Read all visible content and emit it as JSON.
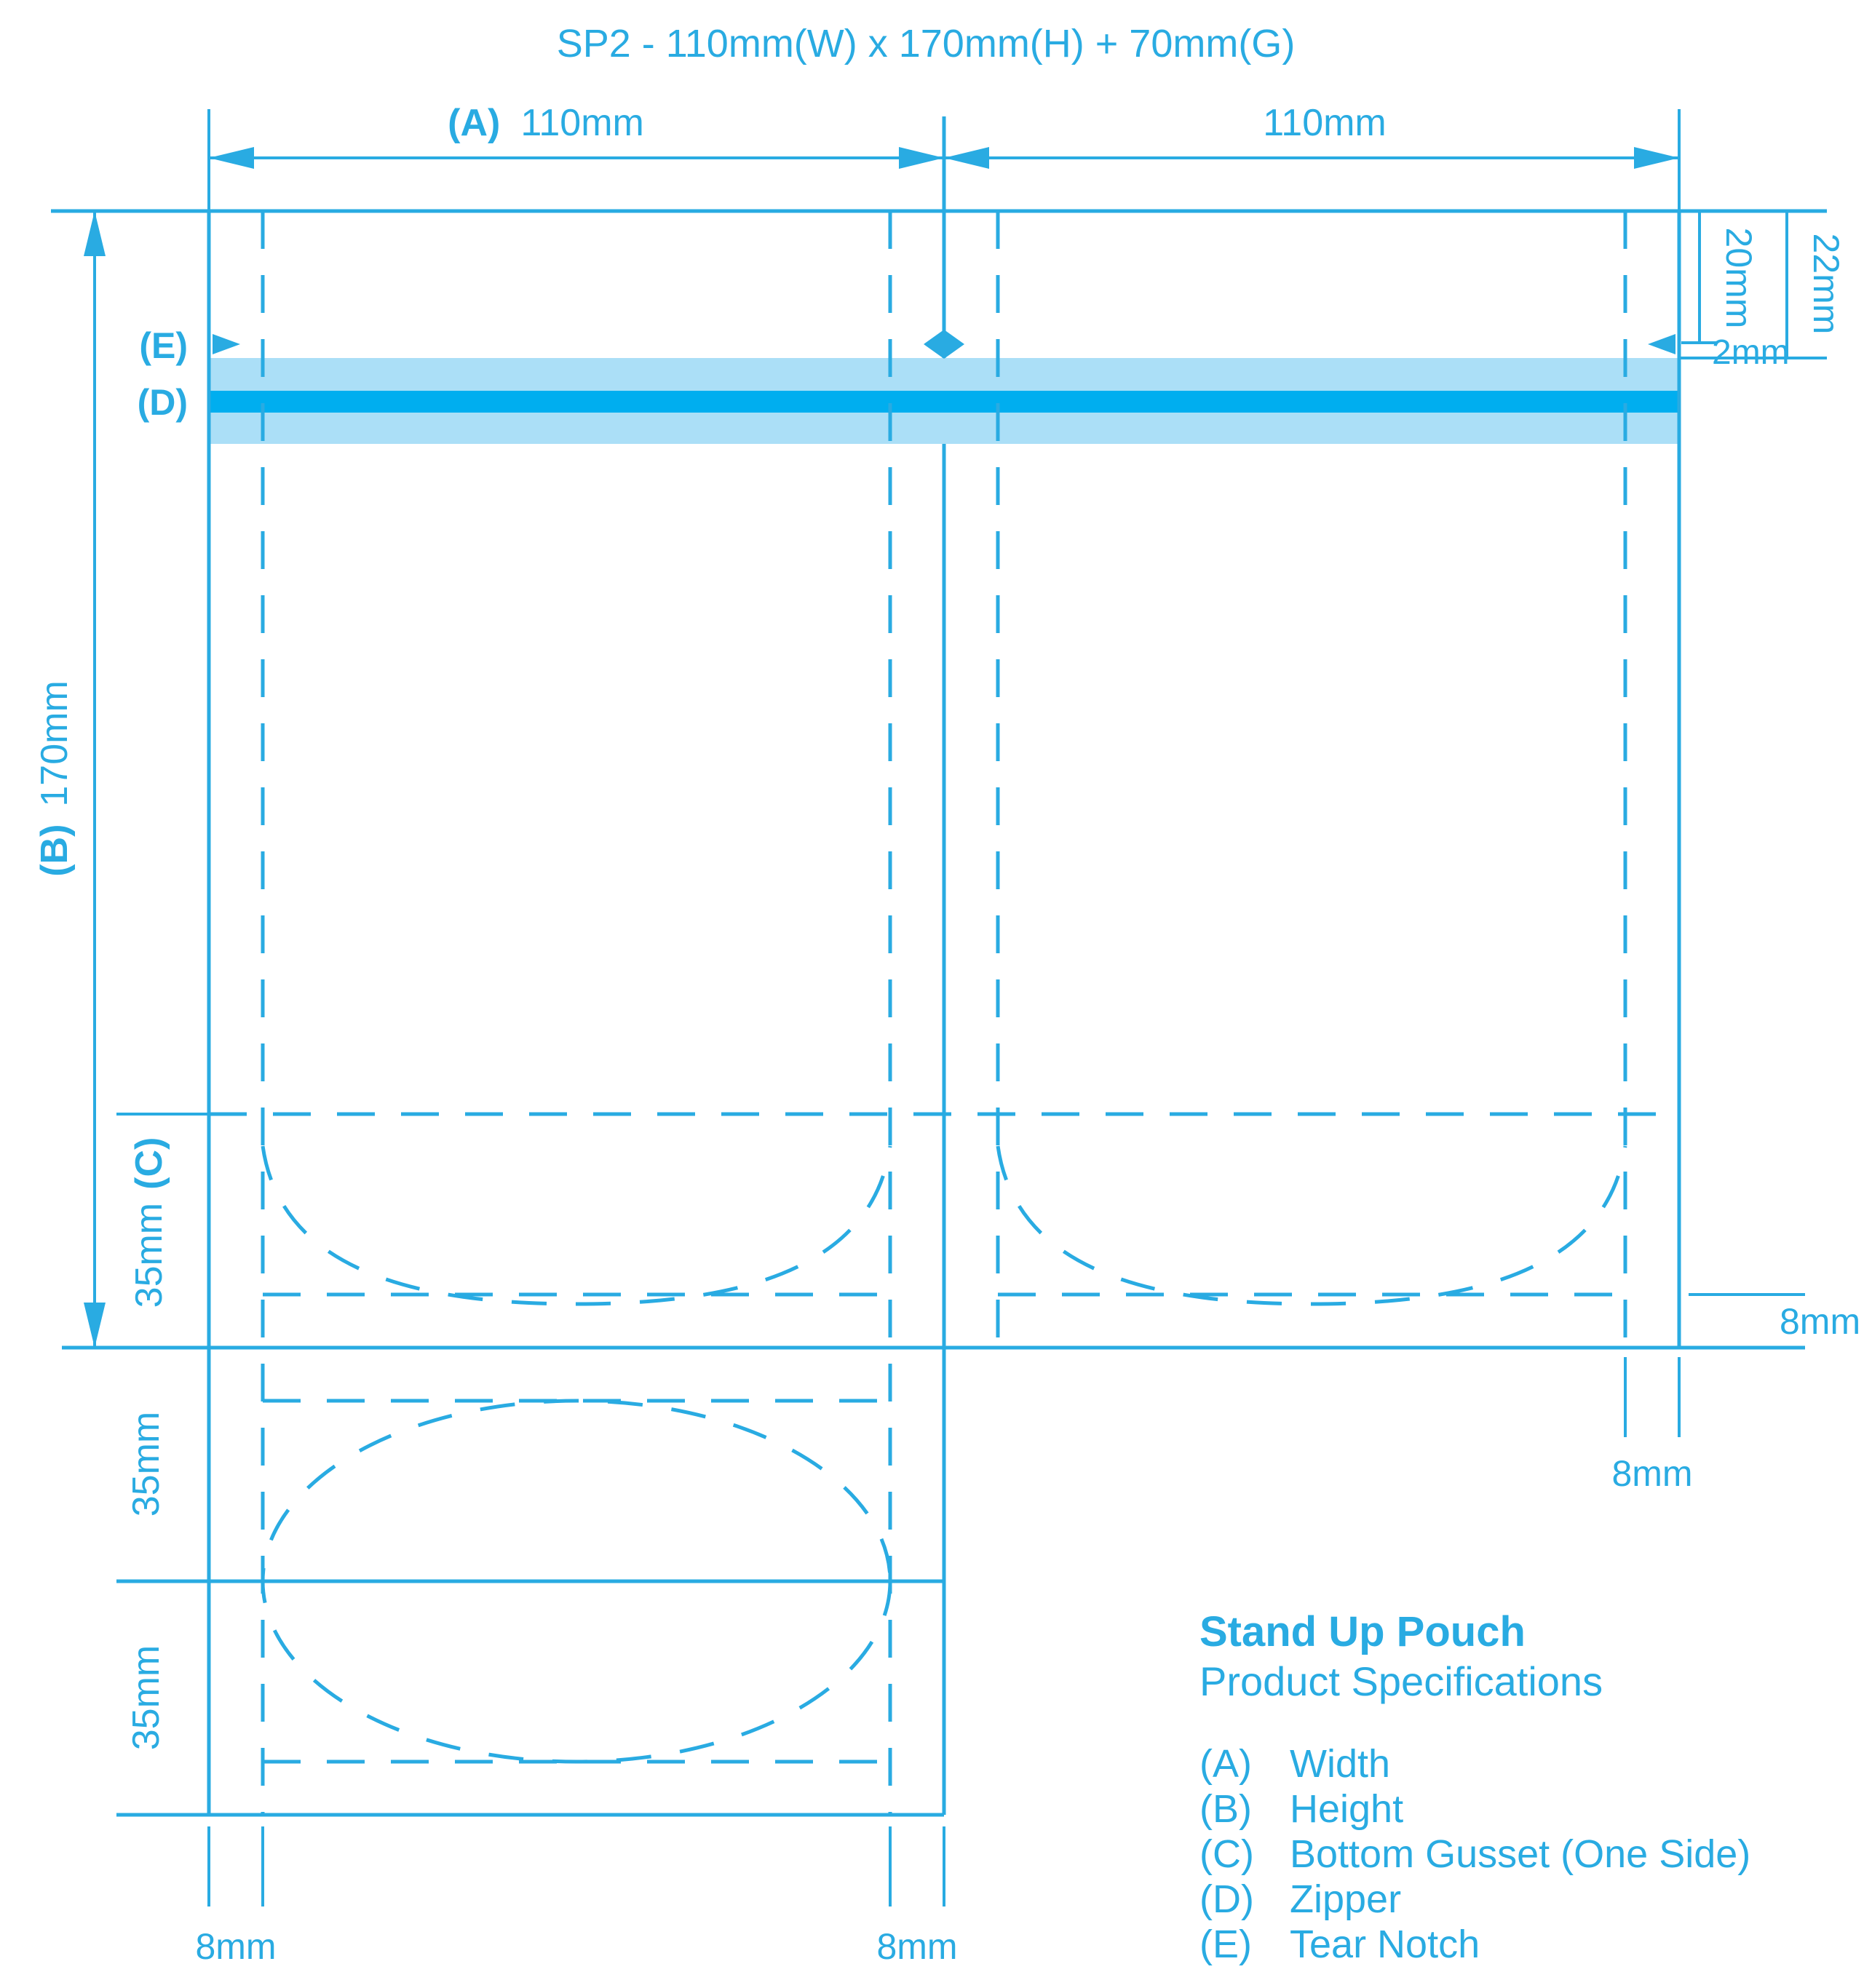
{
  "title": "SP2 - 110mm(W) x 170mm(H) + 70mm(G)",
  "colors": {
    "accent": "#29ABE2",
    "band_light": "#ABDFF7",
    "band_dark": "#00AEEF",
    "background": "#FFFFFF"
  },
  "dimensions": {
    "top_left_key": "(A)",
    "top_left_value": "110mm",
    "top_right_value": "110mm",
    "height_key": "(B)",
    "height_value": "170mm",
    "gusset_value": "35mm",
    "gusset_key": "(C)",
    "tear_notch_offset": "20mm",
    "band_offset": "22mm",
    "notch_band_gap": "2mm",
    "flap_upper": "35mm",
    "flap_lower": "35mm",
    "seal_bottom_left": "8mm",
    "seal_bottom_center": "8mm",
    "seal_right_side": "8mm",
    "seal_right_bottom": "8mm"
  },
  "callouts": {
    "tear_notch": "(E)",
    "zipper": "(D)"
  },
  "legend": {
    "heading": "Stand Up Pouch",
    "subheading": "Product Specifications",
    "items": [
      {
        "key": "(A)",
        "label": "Width"
      },
      {
        "key": "(B)",
        "label": "Height"
      },
      {
        "key": "(C)",
        "label": "Bottom Gusset (One Side)"
      },
      {
        "key": "(D)",
        "label": "Zipper"
      },
      {
        "key": "(E)",
        "label": "Tear Notch"
      }
    ]
  }
}
